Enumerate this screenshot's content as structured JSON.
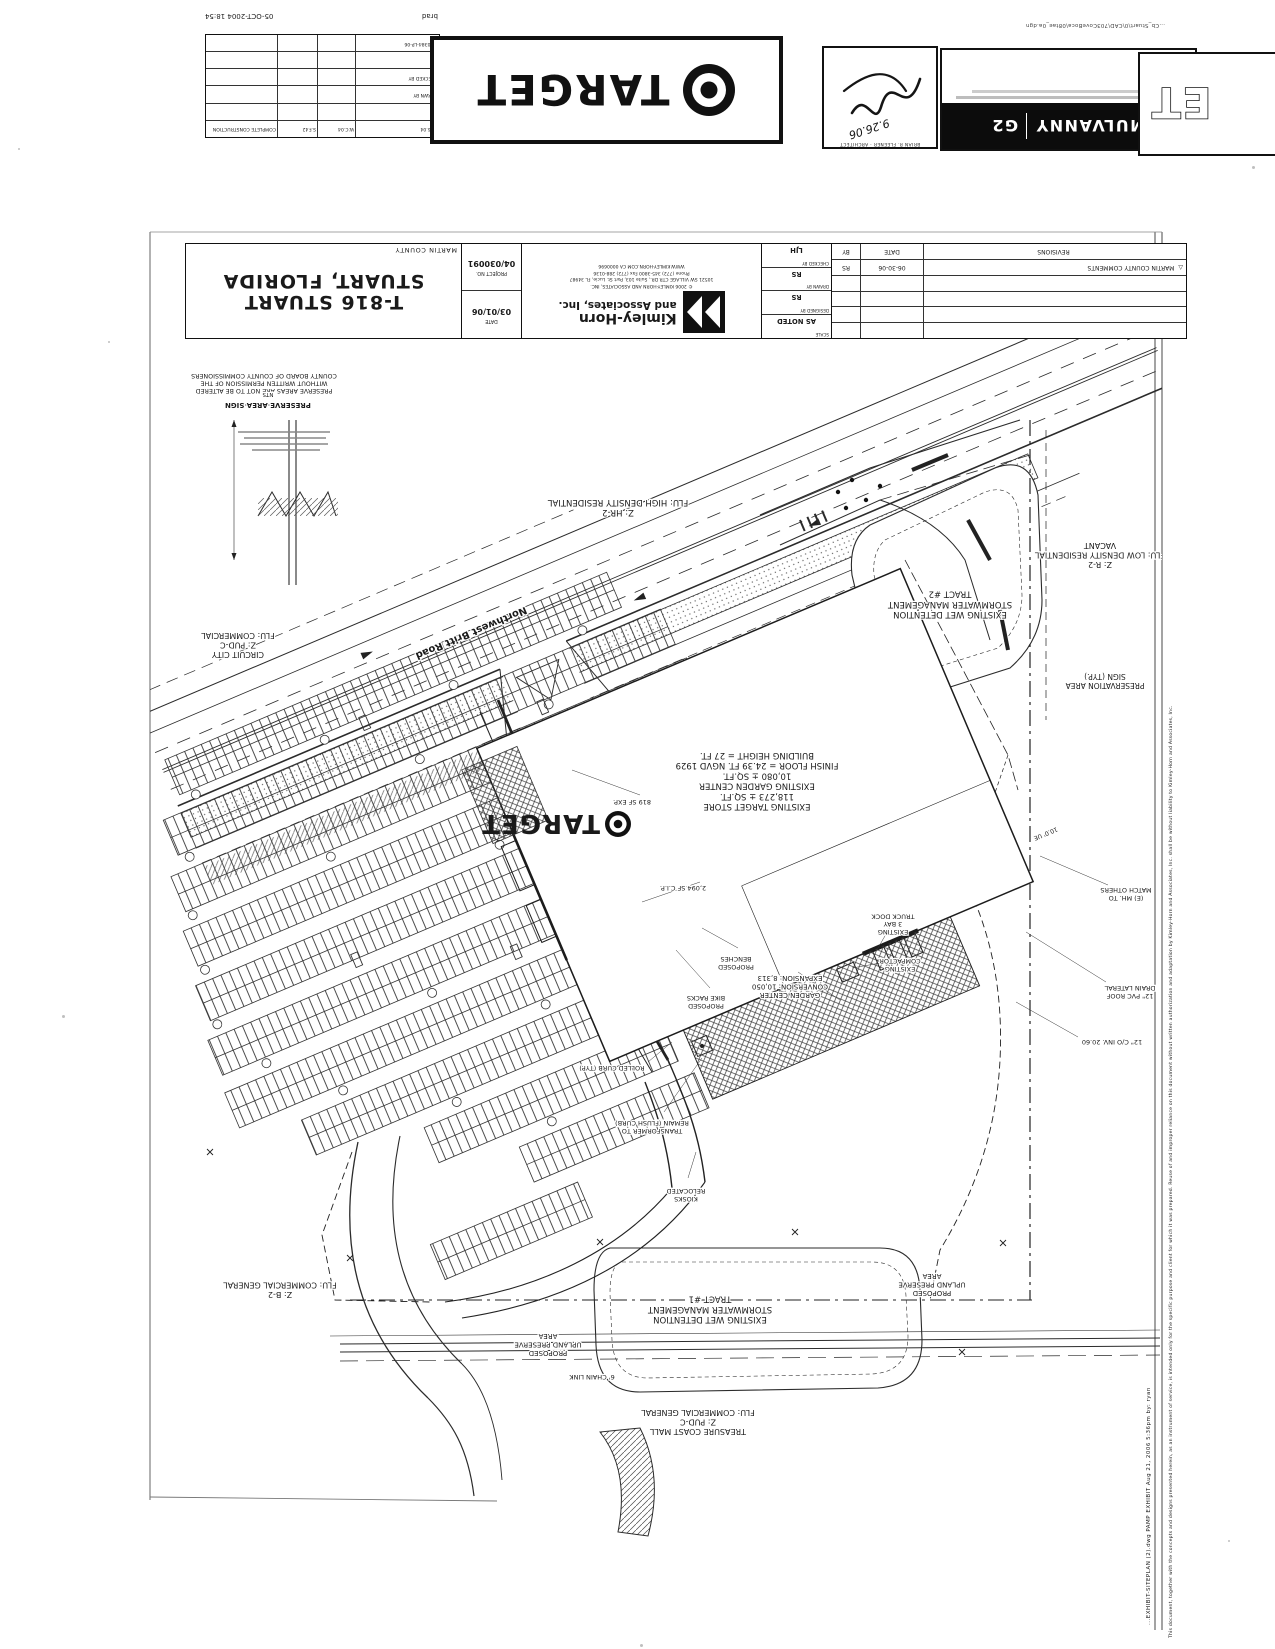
{
  "document": {
    "plot_user": "brad",
    "plot_datetime": "05-OCT-2004 18:54",
    "file_path": "...Cb_Stuart\\0\\CAD\\703CoveBoca\\08tae_0a.dgn"
  },
  "approval_table": {
    "rows": [
      {
        "label": "4.26.04",
        "c1": "W.C.04",
        "c2": "S.F.42",
        "c3": "COMPLETE CONSTRUCTION"
      },
      {
        "label": "",
        "c1": "",
        "c2": "",
        "c3": ""
      },
      {
        "label": "DRAWN BY",
        "c1": "",
        "c2": "",
        "c3": ""
      },
      {
        "label": "CHECKED BY",
        "c1": "",
        "c2": "",
        "c3": ""
      },
      {
        "label": "",
        "c1": "",
        "c2": "",
        "c3": ""
      },
      {
        "label": "05-0384-LP-06",
        "c1": "",
        "c2": "",
        "c3": ""
      }
    ]
  },
  "target_logo": {
    "word": "TARGET"
  },
  "architect_stamp": {
    "title": "BRIAN R. FLEENER · ARCHITECT",
    "signature_date": "9.26.06"
  },
  "mulvanny": {
    "brand_left": "MULVANNY",
    "brand_right": "G2"
  },
  "corner_logo": {
    "letters": "ET"
  },
  "title_block": {
    "title_line1": "T-816 STUART",
    "title_line2": "STUART, FLORIDA",
    "county": "MARTIN COUNTY",
    "project_no_label": "PROJECT NO.",
    "project_no": "04/030091",
    "date_label": "DATE",
    "date": "03/01/06",
    "scale_label": "SCALE",
    "scale": "AS NOTED",
    "designed_label": "DESIGNED BY",
    "designed": "RS",
    "drawn_label": "DRAWN BY",
    "drawn": "RS",
    "checked_label": "CHECKED BY",
    "checked": "LJH",
    "firm_name": "Kimley-Horn",
    "firm_name2": "and Associates, Inc.",
    "firm_copyright": "© 2006 KIMLEY-HORN AND ASSOCIATES, INC.",
    "firm_address": "10521 SW VILLAGE CTR DR., Suite 103, Port St. Lucie, FL 34987",
    "firm_phone": "Phone (772) 345-3800   Fax (772) 288-0136",
    "firm_web": "WWW.KIMLEY-HORN.COM    CA 0000696"
  },
  "revisions": {
    "header_rev": "REVISIONS",
    "header_date": "DATE",
    "header_by": "BY",
    "delta": "△",
    "entry_rev": "MARTIN COUNTY COMMENTS",
    "entry_date": "06-30-06",
    "entry_by": "RS"
  },
  "right_edge": {
    "plot_stamp": "...EXHIBIT-SITEPLAN (2).dwg   PAMP EXHIBIT   Aug 21, 2006  5:36pm   by: ryan",
    "disclaimer": "This document, together with the concepts and designs presented herein, as an instrument of service, is intended only for the specific purpose and client for which it was prepared. Reuse of and improper reliance on this document without written authorization and adaptation by Kimley-Horn and Associates, Inc. shall be without liability to Kimley-Horn and Associates, Inc."
  },
  "plan": {
    "building_logo_word": "TARGET",
    "labels": [
      {
        "name": "road-name",
        "x": 470,
        "y": 630,
        "size": 10,
        "bold": true,
        "rot": 157,
        "lines": [
          "Northwest Britt Road"
        ]
      },
      {
        "name": "zone-hr2",
        "x": 618,
        "y": 510,
        "size": 8.5,
        "lines": [
          "Z: HR-2",
          "FLU: HIGH DENSITY RESIDENTIAL"
        ]
      },
      {
        "name": "zone-r2",
        "x": 1100,
        "y": 562,
        "size": 8,
        "lines": [
          "Z: R-2",
          "FLU: LOW DENSITY RESIDENTIAL",
          "VACANT"
        ]
      },
      {
        "name": "tract2",
        "x": 950,
        "y": 612,
        "size": 8.5,
        "lines": [
          "EXISTING WET DETENTION",
          "STORMWATER MANAGEMENT",
          "TRACT #2"
        ]
      },
      {
        "name": "preservation-sign",
        "x": 1105,
        "y": 683,
        "size": 7.5,
        "lines": [
          "PRESERVATION AREA",
          "SIGN (TYP.)"
        ]
      },
      {
        "name": "building",
        "x": 757,
        "y": 804,
        "size": 8.5,
        "lines": [
          "EXISTING TARGET STORE",
          "118,273 ± SQ.FT.",
          "EXISTING GARDEN CENTER",
          "10,080 ± SQ.FT.",
          "FINISH FLOOR = 24.39 FT. NGVD 1929",
          "BUILDING HEIGHT = 27 FT."
        ]
      },
      {
        "name": "exp-819",
        "x": 632,
        "y": 800,
        "size": 6.5,
        "lines": [
          "819 SF EXP."
        ]
      },
      {
        "name": "cip-2094",
        "x": 683,
        "y": 886,
        "size": 6.5,
        "lines": [
          "2,094 SF C.I.P."
        ]
      },
      {
        "name": "benches",
        "x": 736,
        "y": 965,
        "size": 6.5,
        "lines": [
          "PROPOSED",
          "BENCHES"
        ]
      },
      {
        "name": "bike-racks",
        "x": 706,
        "y": 1004,
        "size": 6.5,
        "lines": [
          "PROPOSED",
          "BIKE RACKS"
        ]
      },
      {
        "name": "garden-expansion",
        "x": 790,
        "y": 993,
        "size": 7,
        "lines": [
          "GARDEN CENTER",
          "CONVERSION: 10,050",
          "EXPANSION: 8,313"
        ]
      },
      {
        "name": "truck-dock",
        "x": 893,
        "y": 930,
        "size": 6.5,
        "lines": [
          "EXISTING",
          "3 BAY",
          "TRUCK DOCK"
        ]
      },
      {
        "name": "compactor",
        "x": 900,
        "y": 967,
        "size": 6.5,
        "lines": [
          "EXISTING",
          "COMPACTOR"
        ]
      },
      {
        "name": "mh-match",
        "x": 1126,
        "y": 896,
        "size": 6.5,
        "lines": [
          "(E) MH. TO",
          "MATCH OTHERS"
        ]
      },
      {
        "name": "roof-drain",
        "x": 1130,
        "y": 994,
        "size": 6.5,
        "lines": [
          "12\" PVC ROOF",
          "DRAIN LATERAL"
        ]
      },
      {
        "name": "co-inv",
        "x": 1112,
        "y": 1040,
        "size": 6.5,
        "lines": [
          "12\" C/O INV. 20.60"
        ]
      },
      {
        "name": "ue",
        "x": 1045,
        "y": 832,
        "size": 6,
        "rot": 157,
        "lines": [
          "10.0' UE"
        ]
      },
      {
        "name": "rolled-curb",
        "x": 612,
        "y": 1066,
        "size": 6.5,
        "lines": [
          "ROLLED CURB (TYP)"
        ]
      },
      {
        "name": "transformer",
        "x": 652,
        "y": 1129,
        "size": 6.5,
        "lines": [
          "TRANSFORMER TO",
          "REMAIN (FLUSH CURB)"
        ]
      },
      {
        "name": "kiosks",
        "x": 686,
        "y": 1197,
        "size": 6.5,
        "lines": [
          "KIOSKS",
          "RELOCATED"
        ]
      },
      {
        "name": "tract1",
        "x": 710,
        "y": 1317,
        "size": 8.5,
        "lines": [
          "EXISTING WET DETENTION",
          "STORMWATER MANAGEMENT",
          "TRACT #1"
        ]
      },
      {
        "name": "upland-right",
        "x": 932,
        "y": 1291,
        "size": 7,
        "lines": [
          "PROPOSED",
          "UPLAND PRESERVE",
          "AREA"
        ]
      },
      {
        "name": "upland-left",
        "x": 548,
        "y": 1351,
        "size": 7,
        "lines": [
          "PROPOSED",
          "UPLAND PRESERVE",
          "AREA"
        ]
      },
      {
        "name": "chain-link",
        "x": 592,
        "y": 1375,
        "size": 6.5,
        "lines": [
          "6' CHAIN LINK"
        ]
      },
      {
        "name": "mall",
        "x": 698,
        "y": 1429,
        "size": 8,
        "lines": [
          "TREASURE COAST MALL",
          "Z: PUD-C",
          "FLU: COMMERCIAL GENERAL"
        ]
      },
      {
        "name": "zone-b2",
        "x": 280,
        "y": 1292,
        "size": 8,
        "lines": [
          "Z: B-2",
          "FLU: COMMERCIAL GENERAL"
        ]
      },
      {
        "name": "circuit-city",
        "x": 238,
        "y": 652,
        "size": 8,
        "lines": [
          "CIRCUIT CITY",
          "Z: PUD-C",
          "FLU: COMMERCIAL"
        ]
      },
      {
        "name": "preserve-note",
        "x": 264,
        "y": 389,
        "size": 6.3,
        "lines": [
          "PRESERVE AREAS ARE NOT TO BE ALTERED",
          "WITHOUT WRITTEN PERMISSION OF THE",
          "COUNTY BOARD OF COUNTY COMMISSIONERS"
        ]
      },
      {
        "name": "sign-detail-title",
        "x": 268,
        "y": 403,
        "size": 7,
        "bold": true,
        "lines": [
          "PRESERVE AREA SIGN"
        ]
      },
      {
        "name": "sign-detail-nts",
        "x": 268,
        "y": 393,
        "size": 5.5,
        "lines": [
          "NTS"
        ]
      }
    ]
  }
}
